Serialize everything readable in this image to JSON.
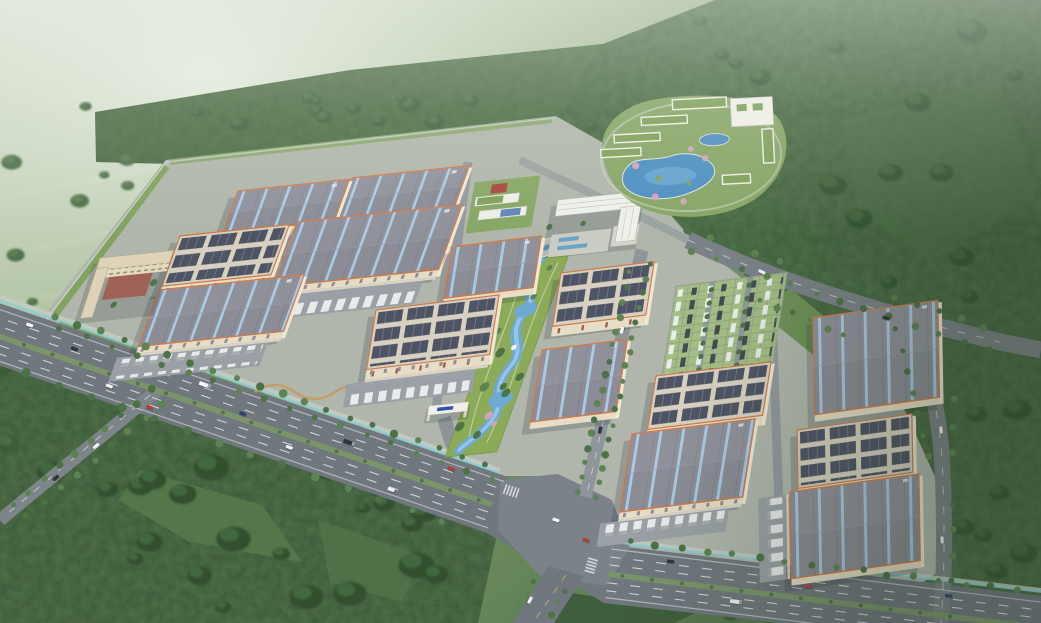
{
  "scene": {
    "type": "aerial-architectural-rendering",
    "description": "Bird's-eye masterplan rendering of a large industrial logistics park set in misty green hills: rows of warehouses with skylight roofs and solar-panel roofs, truck loading docks, a central landscaped green belt with a winding stream, a grass-paver parking lot, an office headquarters with plaza, a dormitory block, a south gate, and a lakeside resort/hotel complex in the forest to the northeast, all bordered by a divided highway with an octagonal intersection.",
    "palette": {
      "haze": "#dfe8db",
      "meadow": "#7e9c6e",
      "forest": "#42603e",
      "forest_dark": "#35502f",
      "park_ground": "#b0b6ac",
      "road": "#70777e",
      "road_light": "#8f969b",
      "plaza_asphalt": "#7b828a",
      "lane_white": "#f2f3f0",
      "median_green": "#7b9569",
      "barrier_cyan": "#7fd3e0",
      "roof_gray": "#8b8c96",
      "skylight_blue": "#a9cbe9",
      "trim_orange": "#cf7a48",
      "wall_cream": "#e7ddc6",
      "solar_dark": "#4e5464",
      "solar_roof": "#d8d1c1",
      "apron": "#9aa0a5",
      "truck_white": "#e9eaea",
      "lawn": "#8cab59",
      "tree": "#4c7246",
      "tree_light": "#5d8352",
      "stream_blue": "#6ea9d4",
      "lake_blue": "#4e8fc0",
      "paver": "#a3bd82",
      "plaza": "#cbccc4",
      "office_white": "#edeee8",
      "court_red": "#a8473a",
      "roof_green": "#7fa05a",
      "dorm_court": "#a2584a",
      "sign_blue": "#2c55aa",
      "blossom_pink": "#d2a3bd"
    },
    "background": {
      "haze_position": "top-left",
      "terrain": [
        "misty farmland",
        "wooded hills",
        "dense forest east and south"
      ]
    },
    "park": {
      "name": "industrial-logistics-park",
      "buildings": [
        {
          "id": "warehouse-b",
          "x": 352,
          "y": 178,
          "w": 118,
          "h": 40,
          "roof": "sky",
          "tilt": "L",
          "apron": "s"
        },
        {
          "id": "warehouse-a",
          "x": 238,
          "y": 191,
          "w": 112,
          "h": 40,
          "roof": "sky",
          "tilt": "L",
          "apron": "s"
        },
        {
          "id": "warehouse-c",
          "x": 297,
          "y": 222,
          "w": 166,
          "h": 62,
          "roof": "sky",
          "tilt": "L",
          "apron": "s"
        },
        {
          "id": "workshop-d",
          "x": 180,
          "y": 236,
          "w": 110,
          "h": 48,
          "roof": "solar",
          "tilt": "L",
          "apron": null
        },
        {
          "id": "warehouse-h",
          "x": 452,
          "y": 247,
          "w": 90,
          "h": 50,
          "roof": "sky",
          "tilt": "C",
          "apron": null
        },
        {
          "id": "workshop-j",
          "x": 561,
          "y": 273,
          "w": 94,
          "h": 52,
          "roof": "solar",
          "tilt": "C",
          "apron": null
        },
        {
          "id": "warehouse-e",
          "x": 159,
          "y": 290,
          "w": 146,
          "h": 54,
          "roof": "sky",
          "tilt": "L",
          "apron": "s"
        },
        {
          "id": "workshop-g",
          "x": 376,
          "y": 310,
          "w": 124,
          "h": 58,
          "roof": "solar",
          "tilt": "C",
          "apron": "s"
        },
        {
          "id": "warehouse-p",
          "x": 813,
          "y": 318,
          "w": 126,
          "h": 96,
          "roof": "sky",
          "tilt": "R",
          "apron": null
        },
        {
          "id": "warehouse-i",
          "x": 542,
          "y": 350,
          "w": 86,
          "h": 70,
          "roof": "sky",
          "tilt": "C",
          "apron": null
        },
        {
          "id": "workshop-m",
          "x": 656,
          "y": 376,
          "w": 116,
          "h": 52,
          "roof": "solar",
          "tilt": "C",
          "apron": null
        },
        {
          "id": "workshop-q",
          "x": 797,
          "y": 430,
          "w": 116,
          "h": 58,
          "roof": "solar",
          "tilt": "R",
          "apron": null
        },
        {
          "id": "warehouse-n",
          "x": 632,
          "y": 434,
          "w": 124,
          "h": 76,
          "roof": "sky",
          "tilt": "C",
          "apron": "s"
        },
        {
          "id": "warehouse-r",
          "x": 790,
          "y": 492,
          "w": 130,
          "h": 86,
          "roof": "sky",
          "tilt": "R",
          "apron": "w"
        }
      ],
      "features": [
        "central-landscaped-green-belt-with-winding-stream",
        "grass-paver-parking-lot-with-cars",
        "truck-loading-dock-aprons",
        "perimeter-fence-and-lawn-strips",
        "tree-lined-internal-spine-road"
      ],
      "landmarks": [
        {
          "id": "office-headquarters",
          "style": "white multi-storey slab with plaza and pools"
        },
        {
          "id": "dormitory-building",
          "style": "L-shaped cream block with red-brown courtyard"
        },
        {
          "id": "amenity-sports-facility",
          "style": "green-roofed low blocks with red court"
        },
        {
          "id": "south-gate",
          "style": "white gatehouse with blue sign"
        },
        {
          "id": "resort-hotel-complex",
          "style": "white green-roofed wings ringing two blue lakes"
        }
      ]
    },
    "roads": {
      "main_highway": "8-lane divided highway with planted median, cyan barrier fence on park side",
      "intersection": "large octagonal junction at bottom center",
      "branch_roads": 4,
      "internal_streets": "orthogonal grid with tree-lined spine"
    },
    "vehicles": {
      "highway_cars": 16,
      "trucks_at_docks": "rows of white trailers at warehouse aprons"
    },
    "gate_sign": {
      "color": "#2c55aa",
      "readable": false
    }
  }
}
